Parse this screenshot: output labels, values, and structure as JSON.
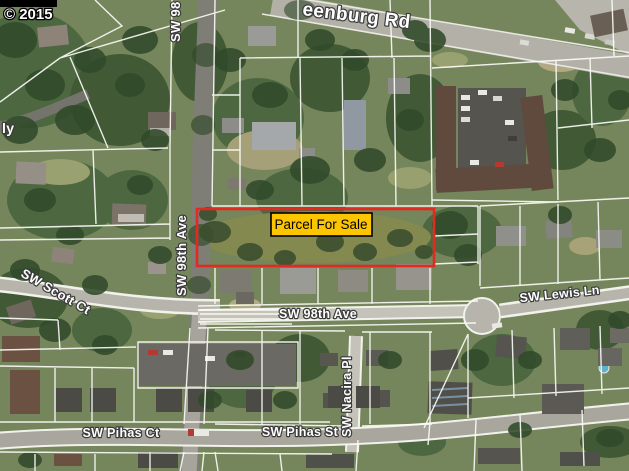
{
  "map": {
    "type": "aerial-satellite-parcel-map",
    "attribution": "© 2015",
    "parcel": {
      "label": "Parcel For Sale"
    },
    "streets": {
      "greenburg_partial": "eenburg Rd",
      "ave98_top_partial": "SW 98",
      "ave98_vertical": "SW 98th Ave",
      "scott_ct": "SW Scott Ct",
      "ave98_horizontal": "SW 98th Ave",
      "lewis_ln": "SW Lewis Ln",
      "nacira_pl": "SW Nacira Pl",
      "pihas_ct": "SW Pihas Ct",
      "pihas_st": "SW Pihas St",
      "left_edge_partial": "ly"
    },
    "colors": {
      "parcel_outline": "#e02b20",
      "parcel_label_bg": "#fdc500",
      "parcel_label_border": "#000000",
      "street_label_fill": "#ffffff",
      "attribution_bg": "#000000",
      "road": "#b6b4ab",
      "lot_line": "#ffffff"
    }
  }
}
